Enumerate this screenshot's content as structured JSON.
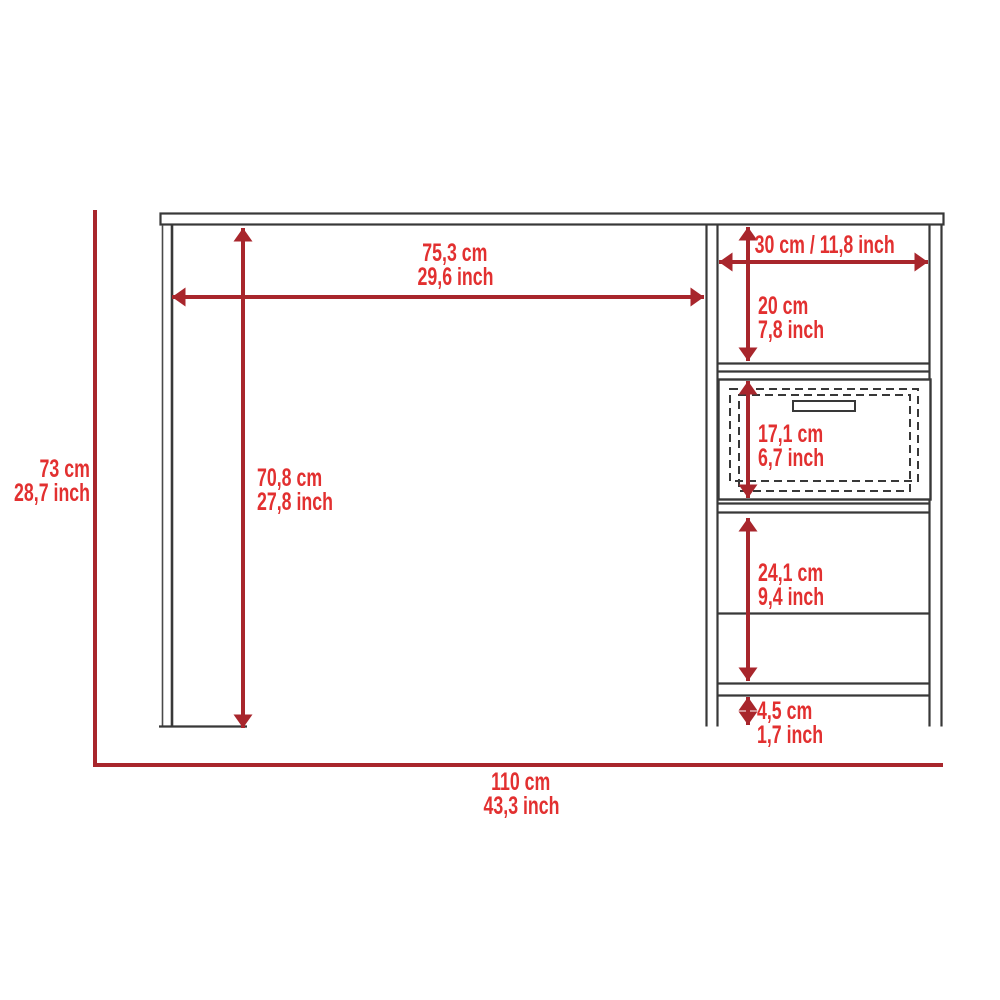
{
  "diagram": {
    "subject": "desk-dimension-diagram-front-elevation",
    "units": [
      "cm",
      "inch"
    ],
    "colors": {
      "dimension_line_red": "#A8262C",
      "dimension_text_red": "#E23030",
      "drawing_line_dark": "#383838",
      "background": "#FFFFFF"
    },
    "dimensions": {
      "overall_width": {
        "cm": "110 cm",
        "inch": "43,3 inch"
      },
      "overall_height": {
        "cm": "73 cm",
        "inch": "28,7 inch"
      },
      "desktop_clear_width": {
        "cm": "75,3 cm",
        "inch": "29,6 inch"
      },
      "leg_clear_height": {
        "cm": "70,8 cm",
        "inch": "27,8 inch"
      },
      "cabinet_width": {
        "label": "30 cm / 11,8 inch"
      },
      "upper_shelf_height": {
        "cm": "20 cm",
        "inch": "7,8 inch"
      },
      "drawer_height": {
        "cm": "17,1 cm",
        "inch": "6,7 inch"
      },
      "lower_shelf_height": {
        "cm": "24,1 cm",
        "inch": "9,4 inch"
      },
      "base_height": {
        "cm": "4,5 cm",
        "inch": "1,7 inch"
      }
    }
  }
}
